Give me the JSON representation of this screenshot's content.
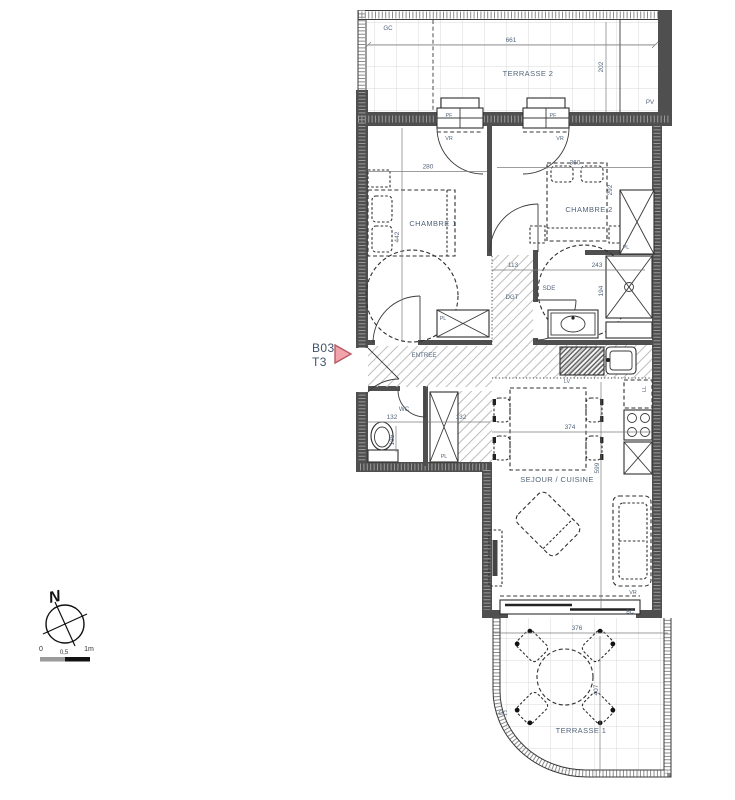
{
  "meta": {
    "unit_code": "B03",
    "unit_type": "T3"
  },
  "compass": {
    "north": "N"
  },
  "scale_bar": {
    "zero": "0",
    "half": "0,5",
    "one": "1m"
  },
  "rooms": {
    "terrasse2": {
      "name": "TERRASSE 2",
      "dim_w": "661",
      "dim_d": "202"
    },
    "chambre1": {
      "name": "CHAMBRE 1",
      "dim_w": "280",
      "dim_d": "442"
    },
    "chambre2": {
      "name": "CHAMBRE 2",
      "dim_w": "360",
      "dim_d": "292"
    },
    "dgt": {
      "name": "DGT",
      "dim_w": "113"
    },
    "sde": {
      "name": "SDE",
      "dim_w": "243",
      "dim_d": "194"
    },
    "entree": {
      "name": "ENTREE"
    },
    "wc": {
      "name": "WC",
      "dim_w": "132",
      "dim_d": "136",
      "dim_pl": "132"
    },
    "sejour": {
      "name": "SEJOUR / CUISINE",
      "dim_w": "374",
      "dim_d": "599"
    },
    "terrasse1": {
      "name": "TERRASSE 1",
      "dim_w": "376",
      "dim_d": "407"
    }
  },
  "tags": {
    "gc_top": "GC",
    "gc_bottom": "GC",
    "pv": "PV",
    "pf_left": "PF",
    "pf_right": "PF",
    "vr_left": "VR",
    "vr_right": "VR",
    "vr_bay": "VR",
    "bc": "BC",
    "pl_chambre2": "PL",
    "pl_chambre1": "PL",
    "pl_wc": "PL",
    "ll": "LL",
    "lv": "LV"
  },
  "colors": {
    "text": "#53657a",
    "wall": "#4f4f4f",
    "dim": "#7c7c7c",
    "arrow_fill": "#f2a3ac",
    "arrow_stroke": "#b85b66",
    "tile_line": "#d9d9d9",
    "hatch_line": "#bdbdbd"
  }
}
